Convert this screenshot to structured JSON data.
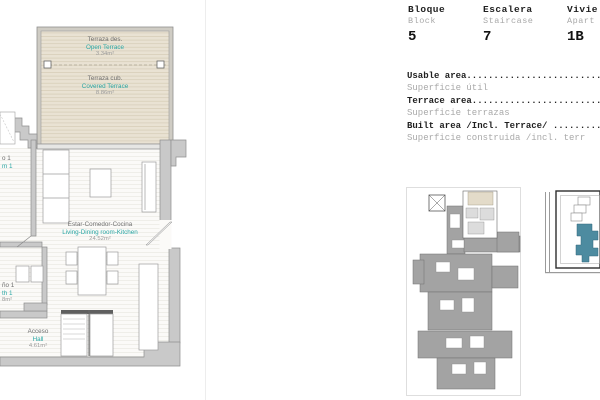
{
  "header": {
    "block": {
      "label": "Bloque",
      "sublabel": "Block",
      "value": "5"
    },
    "staircase": {
      "label": "Escalera",
      "sublabel": "Staircase",
      "value": "7"
    },
    "apartment": {
      "label": "Vivie",
      "sublabel": "Apart",
      "value": "1B"
    }
  },
  "areas": {
    "rows": [
      {
        "text": "Usable area.............................................",
        "kind": "primary"
      },
      {
        "text": "Superficie útil",
        "kind": "secondary"
      },
      {
        "text": "Terrace area............................................",
        "kind": "primary"
      },
      {
        "text": "Superficie terrazas",
        "kind": "secondary"
      },
      {
        "text": "Built area /Incl. Terrace/ .............................",
        "kind": "primary"
      },
      {
        "text": "Superficie construida /incl. terr",
        "kind": "secondary"
      }
    ]
  },
  "plan": {
    "open_terrace": {
      "es": "Terraza des.",
      "en": "Open Terrace",
      "area": "3.34m²"
    },
    "covered_terrace": {
      "es": "Terraza cub.",
      "en": "Covered Terrace",
      "area": "8.86m²"
    },
    "living": {
      "es": "Estar-Comedor-Cocina",
      "en": "Living-Dining room-Kitchen",
      "area": "24.52m²"
    },
    "hall": {
      "es": "Acceso",
      "en": "Hall",
      "area": "4.61m²"
    },
    "bath_fragment": {
      "es": "ño 1",
      "en": "th 1",
      "area": "8m²"
    },
    "bedroom_fragment": {
      "es": "o 1",
      "en": "m 1"
    }
  },
  "colors": {
    "teal_label": "#2aa7a5",
    "label_gray": "#6f6f6f",
    "area_gray": "#9b9b9b",
    "wall_gray": "#c9c9c9",
    "terrace_fill": "#e9e2d3",
    "keyplan_gray": "#a3a3a3",
    "map_teal": "#4d8ba0"
  }
}
